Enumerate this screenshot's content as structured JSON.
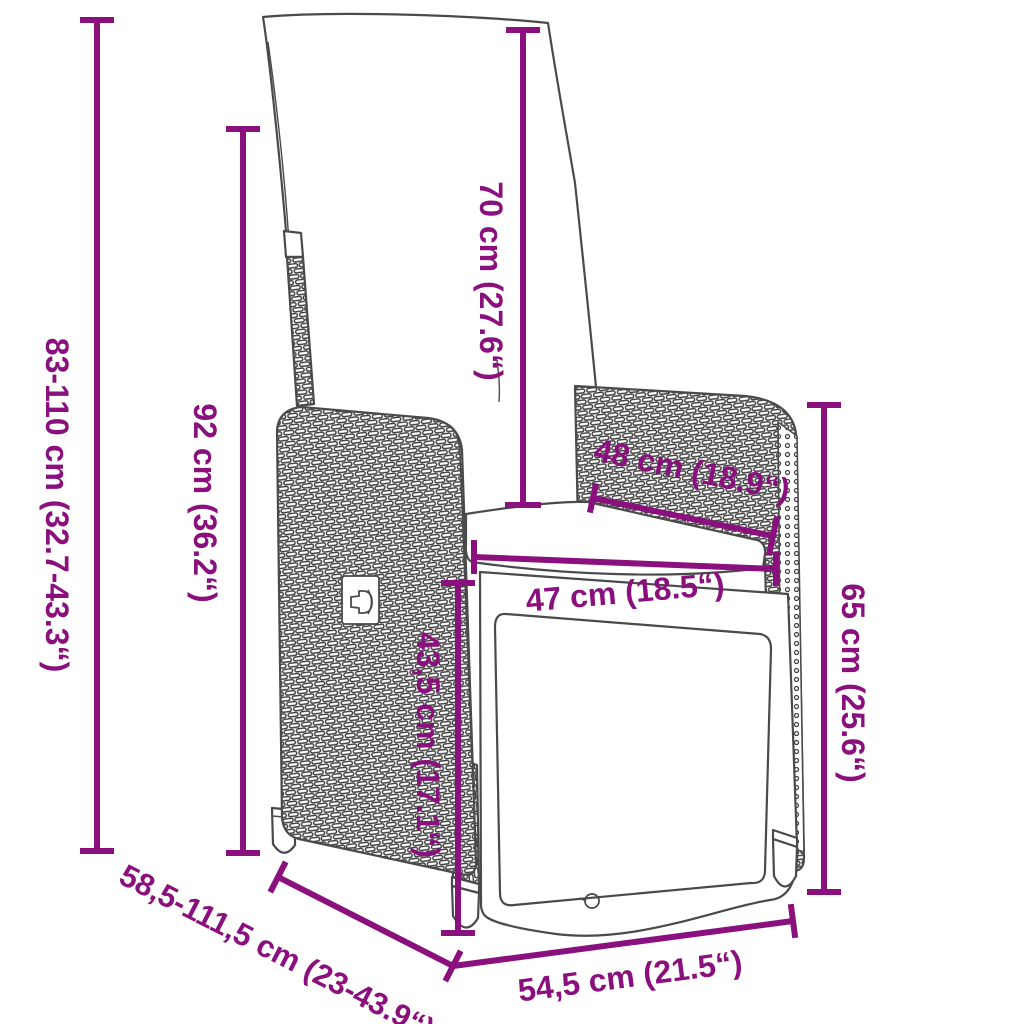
{
  "diagram": {
    "kind": "product-dimension-diagram",
    "subject": "reclining poly rattan garden chair with cushions and footrest"
  },
  "colors": {
    "accent": "#8A107E",
    "line": "#4A4A4A",
    "background": "#FFFFFF"
  },
  "dimensions": {
    "height_total": {
      "label": "83-110 cm (32.7-43.3“)"
    },
    "height_backrest": {
      "label": "92 cm (36.2“)"
    },
    "cushion_height": {
      "label": "70 cm (27.6“)"
    },
    "seat_width_back": {
      "label": "48 cm (18.9“)"
    },
    "seat_depth": {
      "label": "47 cm (18.5“)"
    },
    "footrest_height": {
      "label": "43,5 cm (17.1“)"
    },
    "seat_side_height": {
      "label": "65 cm (25.6“)"
    },
    "depth_range": {
      "label": "58,5-111,5 cm (23-43.9“)"
    },
    "front_width": {
      "label": "54,5 cm (21.5“)"
    }
  }
}
